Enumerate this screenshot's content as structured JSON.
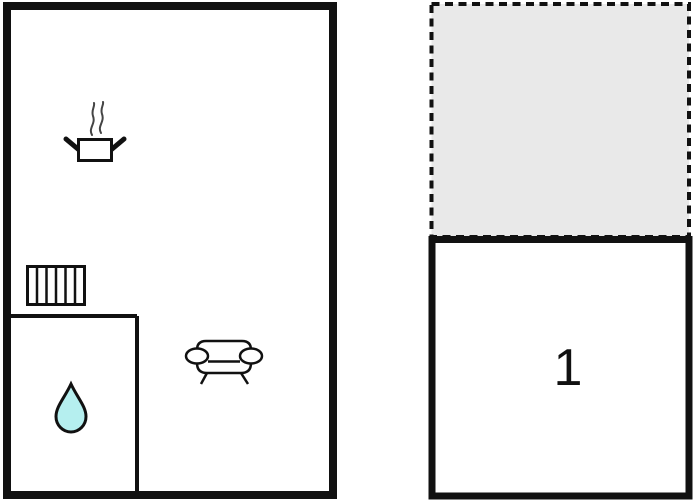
{
  "plan": {
    "type": "floorplan",
    "background": "#ffffff",
    "colors": {
      "wall": "#111111",
      "interior_wall": "#111111",
      "terrace_fill": "#e9e9e9",
      "water_drop_fill": "#b5efef",
      "steam": "#444444",
      "furniture_stroke": "#111111"
    },
    "units": {
      "main": {
        "name": "main-unit",
        "rooms": {
          "living_kitchen": {
            "icons": [
              "cooking-pot-icon",
              "steam-icon",
              "radiator-icon",
              "sofa-icon"
            ]
          },
          "bathroom": {
            "icons": [
              "water-drop-icon"
            ]
          }
        }
      },
      "bedroom": {
        "label": "1"
      },
      "terrace": {
        "border_style": "dashed",
        "fill": "#e9e9e9"
      }
    }
  }
}
